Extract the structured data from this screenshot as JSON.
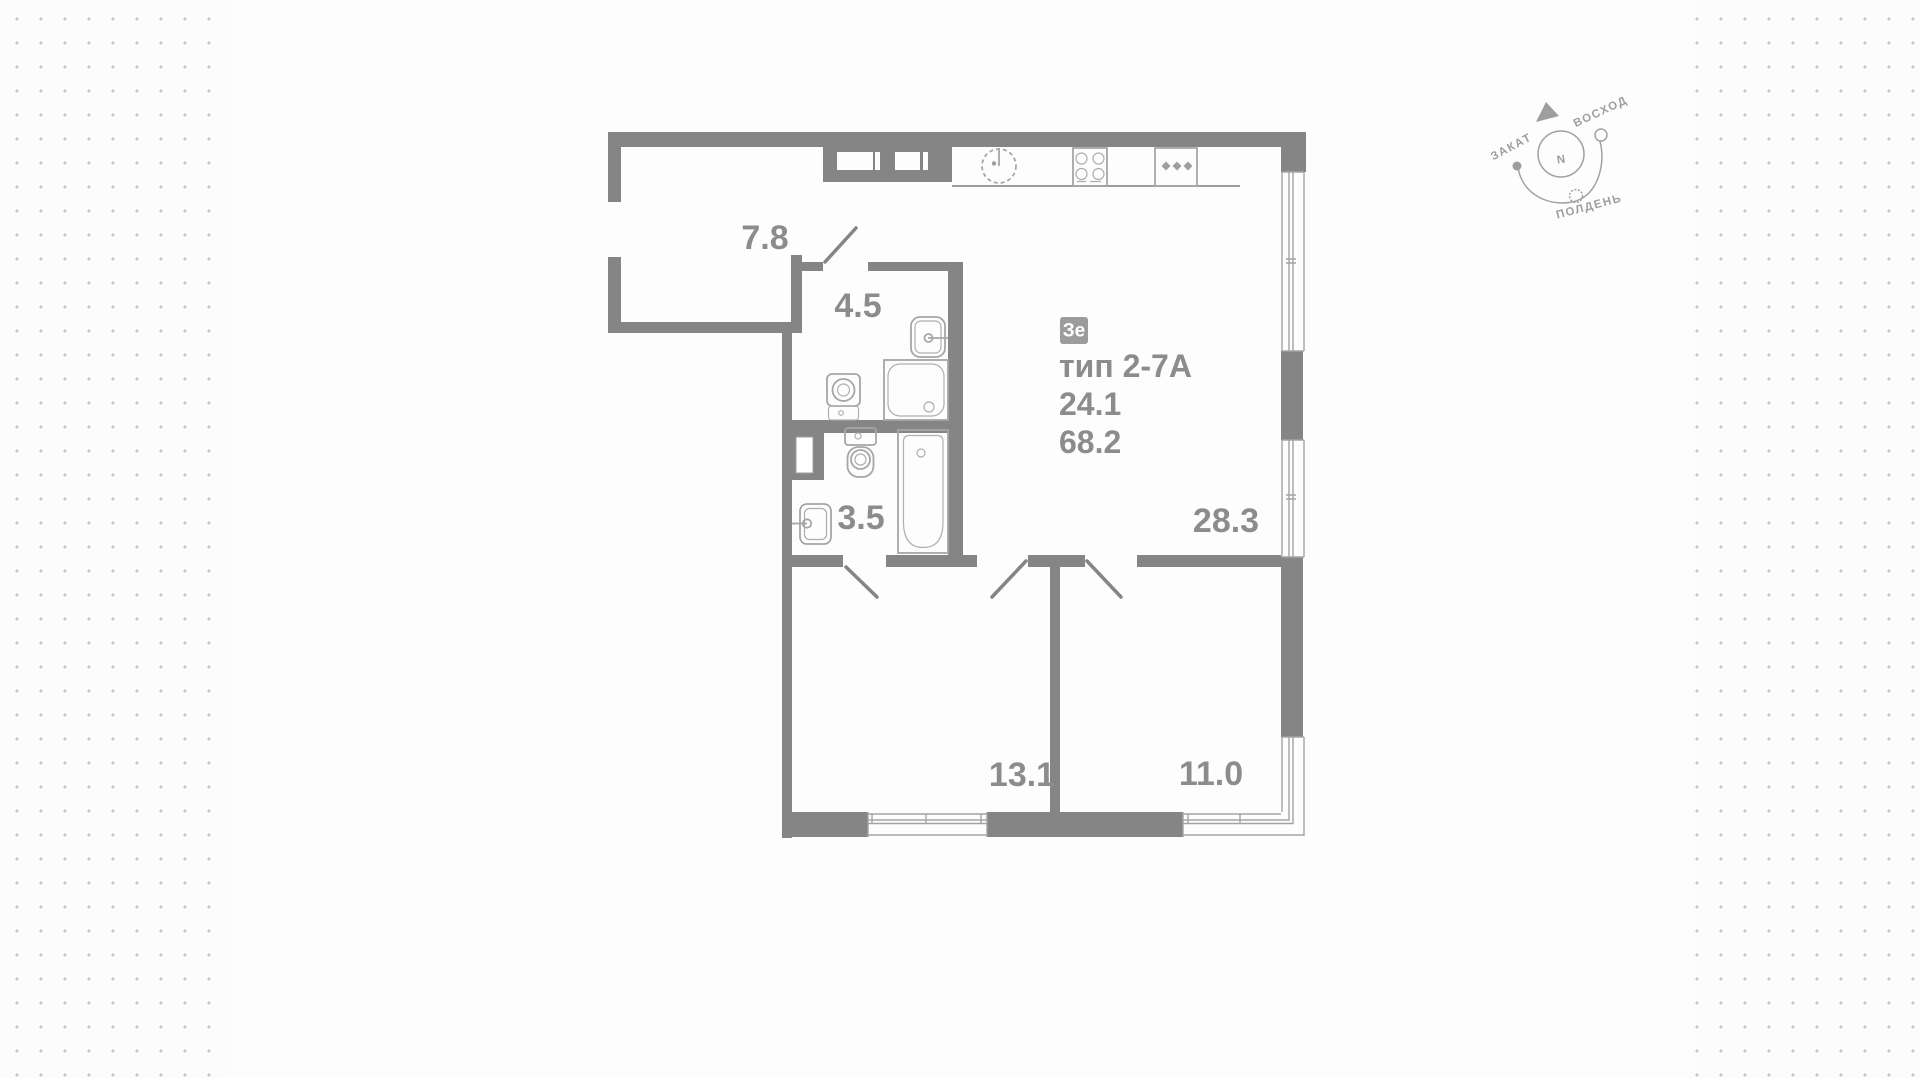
{
  "background": {
    "dot_color": "#c7c7c7",
    "base_color": "#fcfcfc",
    "card_color": "#fdfdfd"
  },
  "plan": {
    "badge_label": "Зе",
    "type_label": "тип 2-7А",
    "living_area": "24.1",
    "total_area": "68.2",
    "rooms": [
      {
        "name": "hallway",
        "area": "7.8"
      },
      {
        "name": "bathroom-shower",
        "area": "4.5"
      },
      {
        "name": "bathroom-tub",
        "area": "3.5"
      },
      {
        "name": "kitchen-living-room",
        "area": "28.3"
      },
      {
        "name": "bedroom-left",
        "area": "13.1"
      },
      {
        "name": "bedroom-right",
        "area": "11.0"
      }
    ],
    "colors": {
      "wall": "#858585",
      "window_line": "#a3a3a3",
      "label": "#8c8c8c",
      "badge_bg": "#9c9c9c",
      "badge_text": "#ffffff"
    }
  },
  "compass": {
    "north_label": "N",
    "sunset_label": "ЗАКАТ",
    "sunrise_label": "ВОСХОД",
    "noon_label": "ПОЛДЕНЬ"
  }
}
